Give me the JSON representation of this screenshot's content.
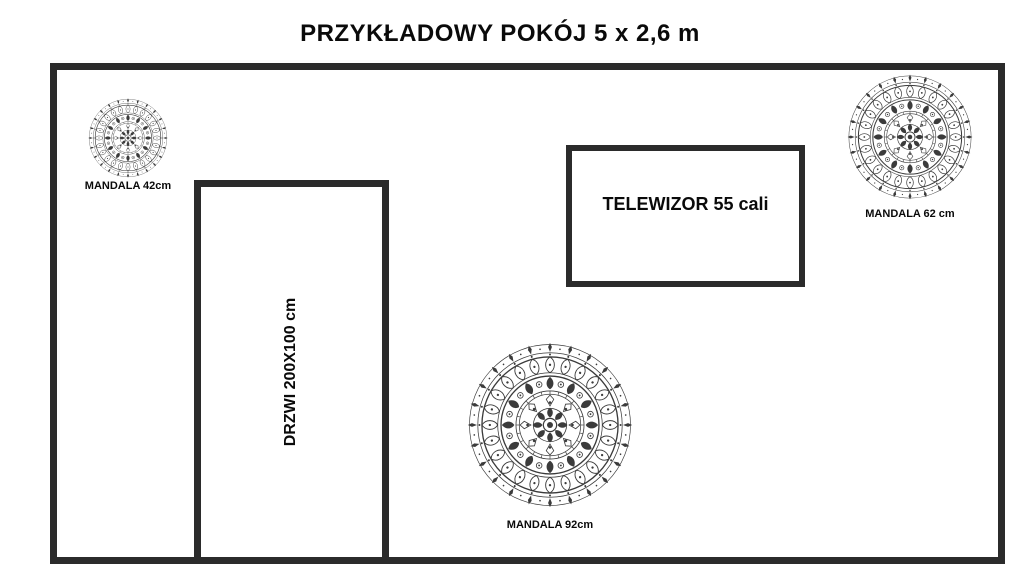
{
  "title": "PRZYKŁADOWY POKÓJ 5 x 2,6 m",
  "room": {
    "door": {
      "label": "DRZWI 200X100 cm"
    },
    "tv": {
      "label": "TELEWIZOR 55 cali"
    },
    "mandalas": [
      {
        "label": "MANDALA 42cm",
        "diameter_px": 80
      },
      {
        "label": "MANDALA 62 cm",
        "diameter_px": 126
      },
      {
        "label": "MANDALA 92cm",
        "diameter_px": 166
      }
    ]
  },
  "colors": {
    "wall": "#2b2b2b",
    "text": "#000000",
    "background": "#ffffff",
    "mandala": "#3b3b3b"
  }
}
